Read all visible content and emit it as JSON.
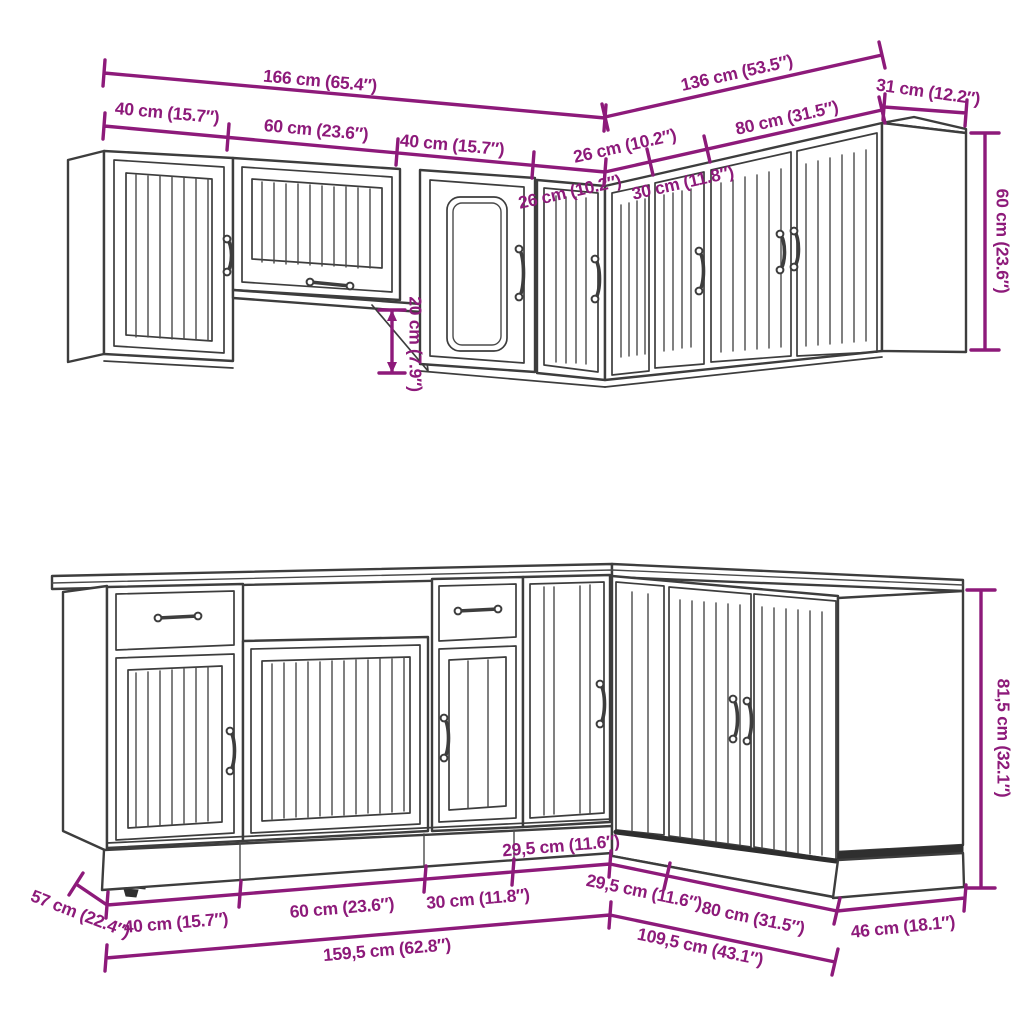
{
  "colors": {
    "background": "#ffffff",
    "line": "#3d3d3d",
    "dimension": "#8d1a7a"
  },
  "diagram": {
    "type": "kitchen-cabinet-set-dimension-drawing",
    "wall_cabinets": {
      "total_width": "166 cm (65.4″)",
      "front_segments": [
        "40 cm (15.7″)",
        "60 cm (23.6″)",
        "40 cm (15.7″)",
        "26 cm (10.2″)"
      ],
      "return_total": "136 cm (53.5″)",
      "return_segments": [
        "26 cm (10.2″)",
        "30 cm (11.8″)",
        "80 cm (31.5″)"
      ],
      "side_depth": "31 cm (12.2″)",
      "height": "60 cm (23.6″)",
      "bridge_gap": "20 cm (7.9″)"
    },
    "base_cabinets": {
      "front_segments": [
        "40 cm (15.7″)",
        "60 cm (23.6″)",
        "30 cm (11.8″)",
        "29,5 cm (11.6″)"
      ],
      "return_segments": [
        "29,5 cm (11.6″)",
        "80 cm (31.5″)"
      ],
      "front_total": "159,5 cm (62.8″)",
      "return_total": "109,5 cm (43.1″)",
      "left_depth": "57 cm (22.4″)",
      "right_depth": "46 cm (18.1″)",
      "height": "81,5 cm (32.1″)"
    }
  }
}
